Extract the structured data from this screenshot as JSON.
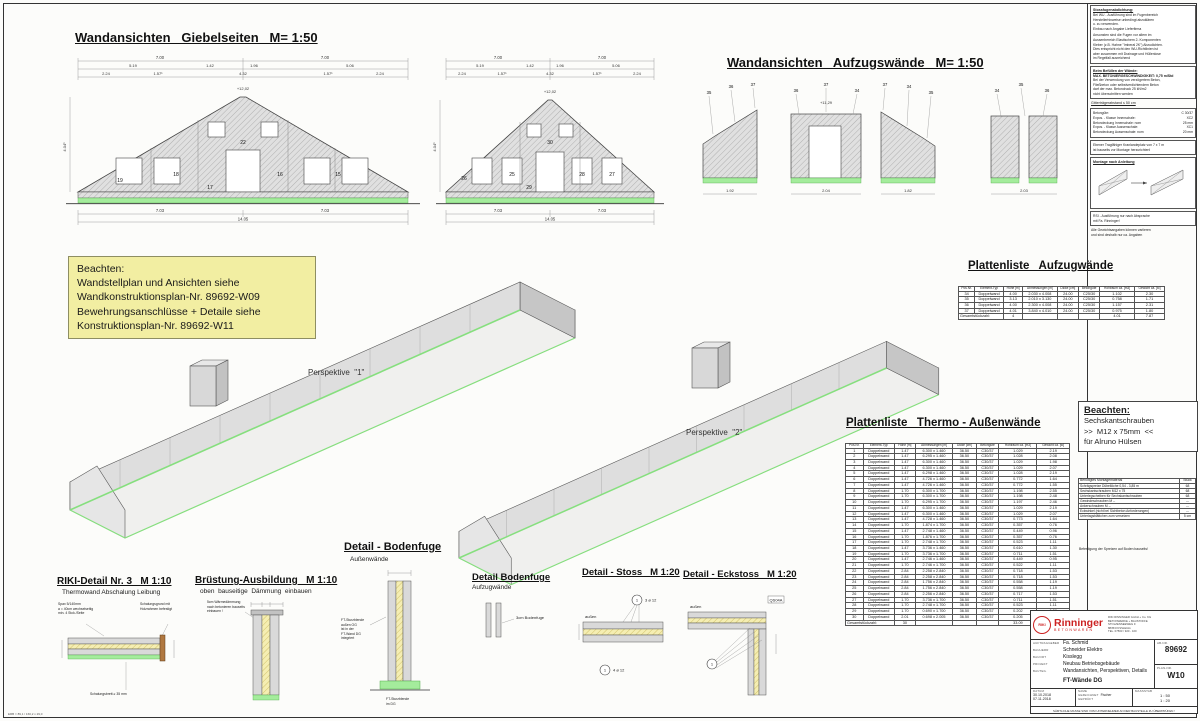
{
  "titles": {
    "giebel": "Wandansichten   Giebelseiten   M= 1:50",
    "aufzug": "Wandansichten   Aufzugswände   M= 1:50",
    "plist_aufzug": "Plattenliste   Aufzugwände",
    "plist_thermo": "Plattenliste   Thermo - Außenwände",
    "persp1": "Perspektive  \"1\"",
    "persp2": "Perspektive  \"2\""
  },
  "note_box": {
    "line1": "Beachten:",
    "line2": "Wandstellplan und  Ansichten siehe",
    "line3": "Wandkonstruktionsplan-Nr. 89692-W09",
    "line4": "Bewehrungsanschlüsse + Detaile siehe",
    "line5": "Konstruktionsplan-Nr. 89692-W11"
  },
  "beachten2": {
    "title": "Beachten:",
    "l1": "Sechskantschrauben",
    "l2": ">>  M12 x 75mm  <<",
    "l3": "für Alruno Hülsen"
  },
  "right_notes": {
    "s1_title": "Stossfugenabdichtung:",
    "s1_p1": "Bei WU - Ausführung sind im Fugenbereich\nHerstellerhinweise unbedingt abzuklären\nu. zu verwenden.\nEinbau nach Angabe Lieferfirma",
    "s1_p2": "Ansonsten sind die Fugen vor allem im\nAussenbereich Elastischem 2- Komponenten\nKleber (z.B. Hahne \"Imberal 2K\") Abzudichten.\nDies entspricht nicht den WU-Richtlinien ist\naber zusammen mit Drainage und Hüllenlose\nim Regelfall ausreichend",
    "s2_title": "Beim Befüllen der Wände:",
    "s2_l1": "MAX. BETONIERGESCHWINDIGKEIT:  0,75 m/Std",
    "s2_p": "Bei der Verwendung von verzögertem Beton,\nFließbeton oder selbstverdichtendem Beton\ndarf der max. Betondruck  25 kN/m2\nnicht überschritten werden",
    "s3": "Gitterträgerabstand   ≤ 50 cm",
    "s4_rows": [
      [
        "Betongüte:",
        "C 30/37"
      ],
      [
        "Expos. - Klasse Innenschale:",
        "XC2"
      ],
      [
        "Betondeckung Innenschale:   nom",
        "25 mm"
      ],
      [
        "Expos. - Klasse Aussenschale:",
        "XC1"
      ],
      [
        "Betondeckung Aussenschale:   nom",
        "20 mm"
      ]
    ],
    "s5": "Ebener Tragfähiger Kranlandeplatz von 7 x 7 m\nist bauseits vor Montage herzurichten!",
    "s6_title": "Montage nach Anleitung",
    "s7": "RSI - Ausführung nur nach Absprache\nmit Fa. Rinninger!",
    "s8": "Alle Gewichtsangaben können variieren\nund sind deshalb nur ca. Angaben"
  },
  "montage": {
    "header": [
      "Benötigtes Montagematerial",
      "Stück"
    ],
    "rows": [
      [
        "Schrägspreize  Dübellöche    0,54 - 3,85 m",
        "68"
      ],
      [
        "Sechskantschrauben       M12 x 75",
        "68"
      ],
      [
        "Unterlegscheiben für Sechskantschrauben",
        "68"
      ],
      [
        "Gewindeschrauben       M --",
        "---"
      ],
      [
        "Ankerschrauben       M --",
        "---"
      ],
      [
        "Eckwinkel (nicht bei Sichtbeton Anforderungen)",
        "---"
      ],
      [
        "Unterlagsblättchen zum versetzen",
        "5 cm"
      ]
    ],
    "footer": "Befestigung der Spreizen auf Boden bauseits!"
  },
  "tables": {
    "aufzug": {
      "headers": [
        "Pos.Nr.",
        "Element-Typ",
        "Höhe [m]",
        "Abmessungen [m]",
        "Dicke [cm]",
        "Betongüte",
        "Hohlraum ca. [m3]",
        "Gewicht ca. [to]"
      ],
      "rows": [
        [
          "34",
          "Doppelwand",
          "4.00",
          "2.030 x 4.008",
          "24.00",
          "C25/30",
          "1.102",
          "2.30"
        ],
        [
          "35",
          "Doppelwand",
          "3.13",
          "2.010 x 3.130",
          "24.00",
          "C25/30",
          "0.758",
          "1.71"
        ],
        [
          "36",
          "Doppelwand",
          "4.00",
          "2.300 x 4.008",
          "24.00",
          "C25/30",
          "1.157",
          "2.31"
        ],
        [
          "37",
          "Doppelwand",
          "4.01",
          "3.840 x 4.010",
          "24.00",
          "C25/30",
          "0.975",
          "1.80"
        ]
      ],
      "total_label": "Gesamtstückzahl:",
      "total_count": "4",
      "total_hohlraum": "4.01",
      "total_gewicht": "7.87"
    },
    "thermo": {
      "headers": [
        "Pos.Nr.",
        "Element-Typ",
        "Höhe [m]",
        "Abmessungen [m]",
        "Dicke [cm]",
        "Betongüte",
        "Hohlraum ca. [m3]",
        "Gewicht ca. [to]"
      ],
      "rows": [
        [
          "1",
          "Doppelwand",
          "1.47",
          "6.300 x 1.460",
          "36.50",
          "C30/37",
          "1.029",
          "2.19"
        ],
        [
          "2",
          "Doppelwand",
          "1.47",
          "6.295 x 1.460",
          "36.50",
          "C30/37",
          "1.028",
          "2.08"
        ],
        [
          "3",
          "Doppelwand",
          "1.47",
          "6.300 x 1.460",
          "36.50",
          "C30/37",
          "1.029",
          "1.98"
        ],
        [
          "4",
          "Doppelwand",
          "1.47",
          "6.300 x 1.460",
          "36.50",
          "C30/37",
          "1.029",
          "2.07"
        ],
        [
          "5",
          "Doppelwand",
          "1.47",
          "6.298 x 1.460",
          "36.50",
          "C30/37",
          "1.028",
          "2.19"
        ],
        [
          "6",
          "Doppelwand",
          "1.47",
          "4.726 x 1.460",
          "36.50",
          "C30/37",
          "0.772",
          "1.64"
        ],
        [
          "7",
          "Doppelwand",
          "1.47",
          "4.726 x 1.460",
          "36.50",
          "C30/37",
          "0.772",
          "1.55"
        ],
        [
          "8",
          "Doppelwand",
          "1.70",
          "6.300 x 1.700",
          "36.50",
          "C30/37",
          "1.198",
          "2.55"
        ],
        [
          "9",
          "Doppelwand",
          "1.70",
          "6.300 x 1.700",
          "36.50",
          "C30/37",
          "1.198",
          "2.48"
        ],
        [
          "10",
          "Doppelwand",
          "1.70",
          "6.295 x 1.700",
          "36.50",
          "C30/37",
          "1.197",
          "2.46"
        ],
        [
          "11",
          "Doppelwand",
          "1.47",
          "6.300 x 1.460",
          "36.50",
          "C30/37",
          "1.029",
          "2.19"
        ],
        [
          "12",
          "Doppelwand",
          "1.47",
          "6.300 x 1.460",
          "36.50",
          "C30/37",
          "1.029",
          "2.07"
        ],
        [
          "13",
          "Doppelwand",
          "1.47",
          "4.728 x 1.460",
          "36.50",
          "C30/37",
          "0.773",
          "1.64"
        ],
        [
          "14",
          "Doppelwand",
          "1.70",
          "1.874 x 1.700",
          "36.50",
          "C30/37",
          "0.357",
          "0.76"
        ],
        [
          "15",
          "Doppelwand",
          "1.47",
          "2.748 x 1.460",
          "36.50",
          "C30/37",
          "0.449",
          "0.96"
        ],
        [
          "16",
          "Doppelwand",
          "1.70",
          "1.876 x 1.700",
          "36.50",
          "C30/37",
          "0.357",
          "0.76"
        ],
        [
          "17",
          "Doppelwand",
          "1.70",
          "2.748 x 1.700",
          "36.50",
          "C30/37",
          "0.523",
          "1.11"
        ],
        [
          "18",
          "Doppelwand",
          "1.47",
          "3.736 x 1.460",
          "36.50",
          "C30/37",
          "0.610",
          "1.30"
        ],
        [
          "19",
          "Doppelwand",
          "1.70",
          "3.736 x 1.700",
          "36.50",
          "C30/37",
          "0.711",
          "1.51"
        ],
        [
          "20",
          "Doppelwand",
          "1.47",
          "2.746 x 1.460",
          "36.50",
          "C30/37",
          "0.449",
          "0.95"
        ],
        [
          "21",
          "Doppelwand",
          "1.70",
          "2.746 x 1.700",
          "36.50",
          "C30/37",
          "0.522",
          "1.11"
        ],
        [
          "22",
          "Doppelwand",
          "2.84",
          "2.258 x 2.840",
          "36.50",
          "C30/37",
          "0.718",
          "1.53"
        ],
        [
          "23",
          "Doppelwand",
          "2.84",
          "2.258 x 2.840",
          "36.50",
          "C30/37",
          "0.718",
          "1.53"
        ],
        [
          "24",
          "Doppelwand",
          "2.84",
          "1.756 x 2.840",
          "36.50",
          "C30/37",
          "0.558",
          "1.19"
        ],
        [
          "25",
          "Doppelwand",
          "2.84",
          "1.756 x 2.840",
          "36.50",
          "C30/37",
          "0.558",
          "1.19"
        ],
        [
          "26",
          "Doppelwand",
          "2.84",
          "2.256 x 2.840",
          "36.50",
          "C30/37",
          "0.717",
          "1.53"
        ],
        [
          "27",
          "Doppelwand",
          "1.70",
          "3.736 x 1.700",
          "36.50",
          "C30/37",
          "0.711",
          "1.51"
        ],
        [
          "28",
          "Doppelwand",
          "1.70",
          "2.748 x 1.700",
          "36.50",
          "C30/37",
          "0.523",
          "1.11"
        ],
        [
          "29",
          "Doppelwand",
          "1.70",
          "0.690 x 1.700",
          "36.50",
          "C30/37",
          "0.202",
          "0.28"
        ],
        [
          "30",
          "Doppelwand",
          "2.01",
          "0.698 x 2.005",
          "36.50",
          "C30/37",
          "0.205",
          "0.38"
        ]
      ],
      "total_label": "Gesamtstückzahl:",
      "total_count": "30",
      "total_hohlraum": "33.09",
      "total_gewicht": "47.71"
    }
  },
  "details": {
    "riki_title": "RIKI-Detail Nr. 3   M 1:10",
    "riki_sub": "Thermowand Abschalung Leibung",
    "riki_a1": "Spax  5/140mm\na = 40cm  wechselseitig\nmin. 4 Stck./Seite",
    "riki_a2": "Schalungsgrund mit\nHolzrahmen befestigt",
    "riki_a3": "Schalungsbrett  ≥ 35 mm",
    "bruestung_title": "Brüstung-Ausbildung   M 1:10",
    "bruestung_sub": "oben  bauseitige  Dämmung  einbauen",
    "bruestung_a1": "5cm Wärmedämmung\nnach betonieren bauseits\neinbauen !",
    "bodenfuge1_title": "Detail - Bodenfuge",
    "bodenfuge1_sub": "Außenwände",
    "bodenfuge1_a1": "FT-Sturzblende\naußen  OG\nist in der\nFT-Wand DG\nintegriert",
    "bodenfuge1_a2": "FT-Sturzblende\nim DG",
    "bodenfuge2_title": "Detail Bodenfuge",
    "bodenfuge2_sub": "Aufzugwände",
    "bodenfuge2_a1": "3cm Bodenfuge",
    "stoss_title": "Detail - Stoss   M 1:20",
    "stoss_mark": "1",
    "stoss_a1": "3 ø 12",
    "stoss_a2": "außen",
    "stoss_a3": "4 ø 12",
    "eckstoss_title": "Detail - Eckstoss   M 1:20",
    "eckstoss_mark": "1",
    "eckstoss_a1": "QS04A",
    "eckstoss_a2": "außen"
  },
  "gable1": {
    "t1": "7.00",
    "t2": "7.00",
    "m1": "5.19",
    "m2": "1.42",
    "m3": "1.96",
    "m4": "5.06",
    "b1": "2.24",
    "b2": "1.57¹",
    "b3": "4.32",
    "b4": "1.57¹",
    "b5": "2.24",
    "bot1": "7.03",
    "bot2": "7.03",
    "total": "14.05",
    "apex": "+12,02",
    "side": "4.04¹",
    "p1": "19",
    "p2": "18",
    "p3": "22",
    "p4": "16",
    "p5": "15",
    "p6": "17"
  },
  "gable2": {
    "t1": "7.00",
    "t2": "7.00",
    "m1": "5.19",
    "m2": "1.42",
    "m3": "1.96",
    "m4": "5.06",
    "b1": "2.24",
    "b2": "1.57¹",
    "b3": "4.32",
    "b4": "1.57¹",
    "b5": "2.24",
    "bot1": "7.03",
    "bot2": "7.03",
    "total": "14.05",
    "apex": "+12,02",
    "side": "4.04¹",
    "p1": "26",
    "p2": "25",
    "p3": "30",
    "p4": "28",
    "p5": "27",
    "p6": "29"
  },
  "aufzugwalls": {
    "g1a": "35",
    "g1b": "36",
    "g1c": "37",
    "g2a": "36",
    "g2b": "37",
    "g2c": "34",
    "g3a": "37",
    "g3b": "34",
    "g3c": "35",
    "g4a": "34",
    "g4b": "35",
    "g4c": "36",
    "lvl": "+11,29",
    "d1": "1.92",
    "d2": "2.04",
    "d3": "1.82",
    "d4": "2.03"
  },
  "titleblock": {
    "logo_riki": "RIKI",
    "logo_name": "Rinninger",
    "logo_sub": "BETONWAREN",
    "addr": "RIKI RINNINGER GmbH + Co. KG\nBETONWERKE + BAUSTOFFE\nSTOLZENSEEWEG 9\n88353 KISSLEGG\nTEL.  07563 / 920 - 100",
    "fields": [
      [
        "AUFTRAGGEBER",
        "Fa. Schmid"
      ],
      [
        "BAUHERR",
        "Schneider Elektro"
      ],
      [
        "BAUORT",
        "Kisslegg"
      ],
      [
        "PROJEKT",
        "Neubau Betriebsgebäude"
      ],
      [
        "BAUTEIL",
        "Wandansichten, Perspektiven, Details"
      ]
    ],
    "bauteil2": "FT-Wände  DG",
    "abnr_label": "AB-NR.",
    "abnr": "89692",
    "massstab_label": "MASSSTAB",
    "massstab": "1 : 50\n1 : 20",
    "plannr_label": "PLAN-NR.",
    "plannr": "W10",
    "datum_label": "DATUM",
    "datum1": "30.10.2018",
    "datum2": "07.11.2018",
    "name_label": "NAME",
    "gez_label": "GEZEICHNET",
    "gez": "Fischer",
    "gep_label": "GEPRÜFT",
    "bottom": "SÄMTLICHE MASSE SIND VOM UNTERNEHMER AN DER BAUSTELLE ZU ÜBERPRÜFEN !"
  },
  "sheet": {
    "corner_note": "ERB = 89,1 / 160,2 x 29,0"
  }
}
